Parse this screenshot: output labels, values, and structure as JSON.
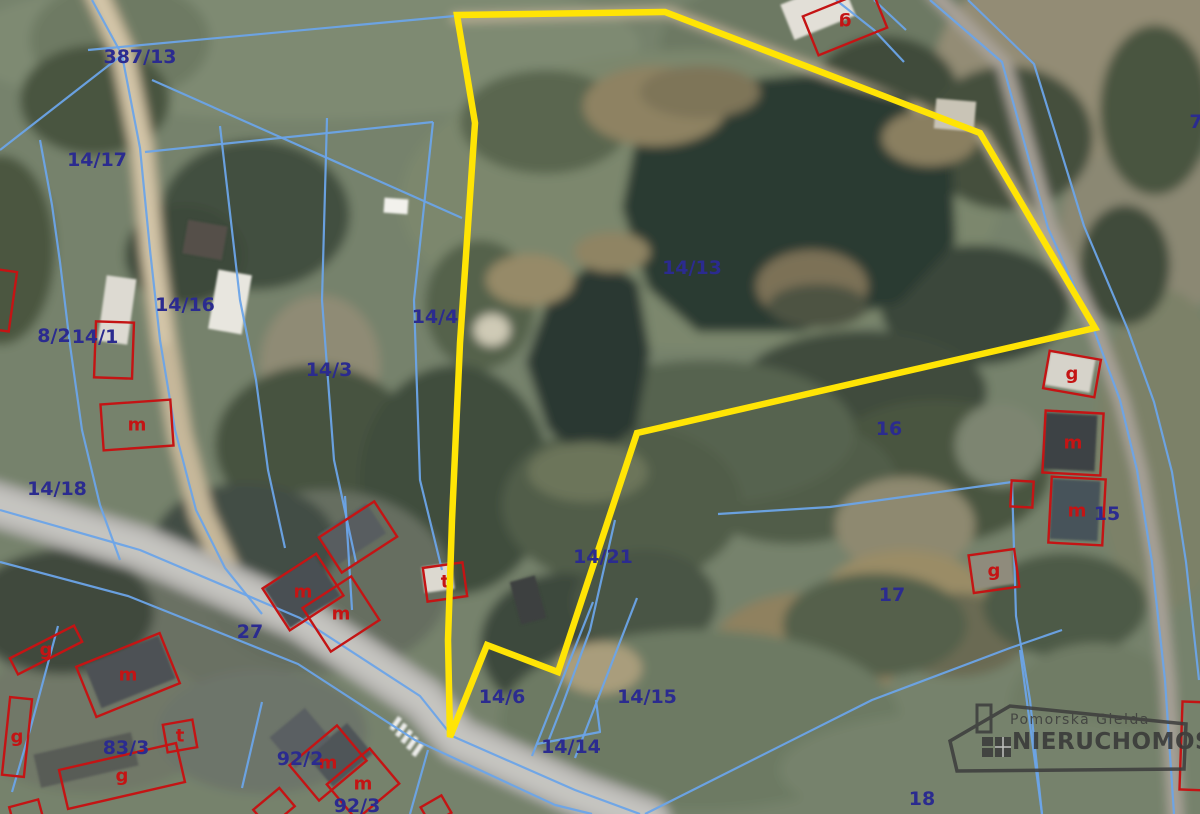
{
  "map": {
    "label_color": "#2b2b8f",
    "label_font_size": 19,
    "building_color": "#c41414",
    "letter_font_size": 18,
    "parcel_labels": [
      {
        "text": "387/13",
        "x": 140,
        "y": 57
      },
      {
        "text": "14/17",
        "x": 97,
        "y": 160
      },
      {
        "text": "14/16",
        "x": 185,
        "y": 305
      },
      {
        "text": "8/2",
        "x": 54,
        "y": 336
      },
      {
        "text": "14/1",
        "x": 95,
        "y": 337
      },
      {
        "text": "14/3",
        "x": 329,
        "y": 370
      },
      {
        "text": "14/4",
        "x": 435,
        "y": 317
      },
      {
        "text": "14/13",
        "x": 692,
        "y": 268
      },
      {
        "text": "14/18",
        "x": 57,
        "y": 489
      },
      {
        "text": "27",
        "x": 250,
        "y": 632
      },
      {
        "text": "14/21",
        "x": 603,
        "y": 557
      },
      {
        "text": "14/6",
        "x": 502,
        "y": 697
      },
      {
        "text": "14/15",
        "x": 647,
        "y": 697
      },
      {
        "text": "14/14",
        "x": 571,
        "y": 747
      },
      {
        "text": "83/3",
        "x": 126,
        "y": 748
      },
      {
        "text": "92/2",
        "x": 300,
        "y": 759
      },
      {
        "text": "92/3",
        "x": 357,
        "y": 806
      },
      {
        "text": "16",
        "x": 889,
        "y": 429
      },
      {
        "text": "17",
        "x": 892,
        "y": 595
      },
      {
        "text": "15",
        "x": 1107,
        "y": 514
      },
      {
        "text": "18",
        "x": 922,
        "y": 799
      },
      {
        "text": "7",
        "x": 1196,
        "y": 122
      }
    ],
    "yellow_boundary": {
      "color": "#ffe405",
      "width": 6.5,
      "points": "457,15 665,12 980,133 1095,328 637,433 558,672 487,645 450,737 448,640 452,520 460,343 475,123"
    },
    "blue_lines": {
      "color": "#6ba4e8",
      "width": 2.2,
      "opacity": 0.95,
      "paths": [
        "92,0 122,55 140,148 150,250 160,340 175,430 196,510 225,568 262,614",
        "40,140 52,205 60,262 70,345 82,430 100,505 120,560",
        "122,55 0,150",
        "88,50 455,16",
        "152,80 462,218",
        "145,152 433,122",
        "220,126 240,300 256,380 268,470 285,548",
        "327,118 322,300 334,460 356,562",
        "433,122 414,300 420,480 442,570",
        "0,510 140,550 300,618 420,696 452,736 575,790 640,814",
        "0,562 128,596 298,664 415,740 555,805 592,814",
        "58,626 30,730 12,792",
        "262,702 242,788",
        "428,750 410,814",
        "345,496 352,610",
        "615,520 590,630 562,706 548,742",
        "593,602 532,756",
        "637,598 575,758",
        "537,744 600,732 596,700",
        "718,514 830,507 1012,482",
        "1012,482 1016,616 1030,700 1042,814",
        "930,0 1002,62 1048,228 1094,330 1120,400 1137,470 1152,562 1165,680 1174,814",
        "968,0 1034,64 1084,226 1128,330 1154,402 1172,472 1186,562 1199,680",
        "836,0 874,30 904,62",
        "874,0 906,30",
        "645,814 872,700 1010,648 1062,630",
        "1020,650 1042,814"
      ]
    },
    "red_buildings": [
      {
        "cx": 114,
        "cy": 350,
        "w": 38,
        "h": 56,
        "rot": 2
      },
      {
        "cx": 137,
        "cy": 425,
        "w": 70,
        "h": 46,
        "rot": -4,
        "letter": "m"
      },
      {
        "cx": 358,
        "cy": 537,
        "w": 66,
        "h": 42,
        "rot": -33
      },
      {
        "cx": 303,
        "cy": 592,
        "w": 64,
        "h": 50,
        "rot": -33,
        "letter": "m"
      },
      {
        "cx": 341,
        "cy": 614,
        "w": 58,
        "h": 52,
        "rot": -33,
        "letter": "m"
      },
      {
        "cx": 445,
        "cy": 582,
        "w": 40,
        "h": 34,
        "rot": -8,
        "letter": "t"
      },
      {
        "cx": 845,
        "cy": 22,
        "w": 74,
        "h": 42,
        "rot": -22,
        "letter": "g",
        "letter_rot": 180
      },
      {
        "cx": 1072,
        "cy": 374,
        "w": 52,
        "h": 38,
        "rot": 10,
        "letter": "g"
      },
      {
        "cx": 1073,
        "cy": 443,
        "w": 58,
        "h": 62,
        "rot": 3,
        "letter": "m"
      },
      {
        "cx": 1077,
        "cy": 511,
        "w": 54,
        "h": 66,
        "rot": 3,
        "letter": "m"
      },
      {
        "cx": 1022,
        "cy": 494,
        "w": 22,
        "h": 26,
        "rot": 3
      },
      {
        "cx": 994,
        "cy": 571,
        "w": 46,
        "h": 38,
        "rot": -8,
        "letter": "g"
      },
      {
        "cx": 46,
        "cy": 650,
        "w": 72,
        "h": 18,
        "rot": -27,
        "letter": "g"
      },
      {
        "cx": 17,
        "cy": 737,
        "w": 22,
        "h": 78,
        "rot": 6,
        "letter": "g"
      },
      {
        "cx": 128,
        "cy": 675,
        "w": 90,
        "h": 54,
        "rot": -22,
        "letter": "m"
      },
      {
        "cx": 180,
        "cy": 736,
        "w": 30,
        "h": 28,
        "rot": -10,
        "letter": "t"
      },
      {
        "cx": 122,
        "cy": 776,
        "w": 120,
        "h": 40,
        "rot": -13,
        "letter": "g"
      },
      {
        "cx": 328,
        "cy": 763,
        "w": 62,
        "h": 46,
        "rot": -40,
        "letter": "m"
      },
      {
        "cx": 363,
        "cy": 784,
        "w": 56,
        "h": 46,
        "rot": -40,
        "letter": "m"
      },
      {
        "cx": 274,
        "cy": 808,
        "w": 34,
        "h": 24,
        "rot": -40
      },
      {
        "cx": 436,
        "cy": 810,
        "w": 24,
        "h": 20,
        "rot": -30
      },
      {
        "cx": 26,
        "cy": 812,
        "w": 30,
        "h": 18,
        "rot": -15
      },
      {
        "cx": 1196,
        "cy": 746,
        "w": 30,
        "h": 88,
        "rot": 2
      },
      {
        "cx": 0,
        "cy": 300,
        "w": 26,
        "h": 60,
        "rot": 8
      }
    ],
    "terrain": {
      "base": "#76826c",
      "patches": [
        [
          300,
          45,
          340,
          75,
          "#7e8a72"
        ],
        [
          120,
          40,
          90,
          60,
          "#6e7a63"
        ],
        [
          840,
          45,
          180,
          80,
          "#6d7963"
        ],
        [
          1090,
          60,
          160,
          120,
          "#938c75",
          -15
        ],
        [
          1150,
          230,
          90,
          90,
          "#8b8873"
        ],
        [
          1165,
          450,
          70,
          160,
          "#7b8168"
        ],
        [
          700,
          200,
          300,
          150,
          "#7b876d"
        ],
        [
          95,
          100,
          75,
          55,
          "#4a553f"
        ],
        [
          0,
          250,
          55,
          95,
          "#4c5741"
        ],
        [
          255,
          215,
          95,
          75,
          "#435040"
        ],
        [
          185,
          255,
          60,
          50,
          "#3e4a3a"
        ],
        [
          545,
          122,
          85,
          52,
          "#5a664f"
        ],
        [
          885,
          98,
          75,
          62,
          "#3f4b3b"
        ],
        [
          1008,
          138,
          85,
          72,
          "#44503e"
        ],
        [
          1155,
          110,
          55,
          85,
          "#49553f"
        ],
        [
          1125,
          265,
          45,
          60,
          "#3f4b3b"
        ],
        [
          480,
          305,
          55,
          65,
          "#55624c"
        ],
        [
          320,
          365,
          60,
          70,
          "#8f8b74"
        ],
        [
          315,
          445,
          100,
          80,
          "#46523f"
        ],
        [
          455,
          480,
          95,
          115,
          "#414d3d"
        ],
        [
          975,
          305,
          95,
          60,
          "#3b473a"
        ],
        [
          862,
          392,
          125,
          62,
          "#404c3c"
        ],
        [
          935,
          472,
          115,
          72,
          "#49553f"
        ],
        [
          792,
          482,
          105,
          62,
          "#515d48"
        ],
        [
          705,
          432,
          150,
          72,
          "#57634f"
        ],
        [
          622,
          505,
          120,
          82,
          "#515d4a"
        ],
        [
          1000,
          445,
          45,
          42,
          "#7d8571"
        ],
        [
          905,
          525,
          70,
          48,
          "#8e8970"
        ],
        [
          150,
          622,
          165,
          95,
          "#6a7163"
        ],
        [
          325,
          582,
          125,
          92,
          "#666e60"
        ],
        [
          92,
          722,
          125,
          72,
          "#717868"
        ],
        [
          262,
          732,
          105,
          62,
          "#6d746a"
        ],
        [
          62,
          612,
          92,
          62,
          "#3f4a3e"
        ],
        [
          245,
          545,
          92,
          62,
          "#434e44"
        ],
        [
          562,
          645,
          82,
          72,
          "#3e4a3c"
        ],
        [
          645,
          602,
          72,
          52,
          "#495445"
        ],
        [
          805,
          655,
          95,
          62,
          "#8f815f"
        ],
        [
          905,
          602,
          85,
          52,
          "#9a8c66"
        ],
        [
          955,
          635,
          72,
          42,
          "#6b6a52"
        ],
        [
          875,
          625,
          92,
          52,
          "#55614b"
        ],
        [
          1065,
          605,
          82,
          52,
          "#4e5a46"
        ],
        [
          1095,
          705,
          85,
          62,
          "#6f7b65"
        ],
        [
          700,
          720,
          200,
          90,
          "#6d7a64"
        ],
        [
          980,
          770,
          200,
          60,
          "#76826c"
        ]
      ],
      "roads": [
        {
          "name": "dirt-road-left",
          "points": "95,-10 122,50 142,148 152,250 164,340 180,435 202,515 230,575",
          "color": "#c6b79a",
          "width": 24
        },
        {
          "name": "dirt-road-left-center",
          "points": "95,-10 122,50 142,148 152,250 164,340",
          "color": "#d6c8ab",
          "width": 11
        },
        {
          "name": "track-top",
          "points": "455,18 668,12 982,134 1094,328",
          "color": "#b9ae94",
          "width": 9
        },
        {
          "name": "road-right",
          "points": "932,-8 1004,64 1050,228 1096,330 1122,402 1140,472 1156,566 1168,684 1176,818",
          "color": "#a8a198",
          "width": 15
        },
        {
          "name": "main-road",
          "points": "-12,502 140,548 300,618 424,700 458,740 578,794 648,820",
          "color": "#b2b1ad",
          "width": 46
        },
        {
          "name": "main-road-center",
          "points": "-12,502 140,548 300,618 424,700 458,740 578,794 648,820",
          "color": "#c5c4c0",
          "width": 26
        }
      ],
      "water": [
        {
          "name": "large-pond",
          "color": "#2c3a33",
          "points": "640,118 706,84 810,74 906,100 952,160 956,242 900,302 800,332 698,332 648,288 622,208"
        },
        {
          "name": "small-pond",
          "color": "#2b3832",
          "points": "548,300 600,256 638,282 650,352 636,428 592,462 548,430 526,362"
        }
      ],
      "overlays": [
        [
          655,
          106,
          72,
          40,
          "#8e8262"
        ],
        [
          930,
          138,
          48,
          28,
          "#8a7f60"
        ],
        [
          700,
          92,
          60,
          26,
          "#7e7458"
        ],
        [
          812,
          286,
          56,
          36,
          "#7b7157"
        ],
        [
          818,
          306,
          50,
          22,
          "#4e5343"
        ],
        [
          530,
          280,
          44,
          26,
          "#968a68"
        ],
        [
          612,
          252,
          38,
          20,
          "#8f8464"
        ],
        [
          588,
          472,
          60,
          30,
          "#6c755a"
        ],
        [
          600,
          668,
          42,
          26,
          "#a99d7c"
        ],
        [
          492,
          330,
          18,
          16,
          "#cfcab6"
        ]
      ],
      "roofs": [
        [
          117,
          310,
          30,
          66,
          8,
          "#dddad2"
        ],
        [
          230,
          302,
          34,
          60,
          10,
          "#e8e6df"
        ],
        [
          396,
          206,
          24,
          15,
          4,
          "#f2f1ec"
        ],
        [
          205,
          240,
          40,
          34,
          10,
          "#55504a"
        ],
        [
          130,
          672,
          80,
          46,
          -22,
          "#4e5154"
        ],
        [
          302,
          592,
          60,
          48,
          -33,
          "#4a4f52"
        ],
        [
          352,
          534,
          58,
          36,
          -33,
          "#585d60"
        ],
        [
          438,
          578,
          30,
          26,
          -8,
          "#dcd9d0"
        ],
        [
          818,
          10,
          66,
          38,
          -22,
          "#e2dfd7"
        ],
        [
          1070,
          372,
          46,
          34,
          10,
          "#d6d3ca"
        ],
        [
          1070,
          442,
          52,
          56,
          3,
          "#3d4245"
        ],
        [
          1075,
          510,
          48,
          60,
          3,
          "#46525a"
        ],
        [
          992,
          570,
          42,
          34,
          -8,
          "#8f8b7c"
        ],
        [
          528,
          600,
          26,
          44,
          -15,
          "#3c4140"
        ],
        [
          86,
          760,
          100,
          34,
          -13,
          "#585b57"
        ],
        [
          340,
          755,
          52,
          40,
          -40,
          "#505459"
        ],
        [
          300,
          738,
          46,
          40,
          -40,
          "#5a5e62"
        ],
        [
          955,
          115,
          40,
          30,
          5,
          "#c9c4b6"
        ]
      ],
      "crosswalk": {
        "x": 398,
        "y": 716,
        "count": 5,
        "dx": 5.5,
        "dy": 6.5,
        "w": 5,
        "h": 15,
        "rot": 35,
        "fill": "#ececea"
      }
    }
  },
  "logo": {
    "line1": "Pomorska Giełda",
    "line2": "NIERUCHOMOŚCI",
    "color": "#3c3c3c"
  }
}
